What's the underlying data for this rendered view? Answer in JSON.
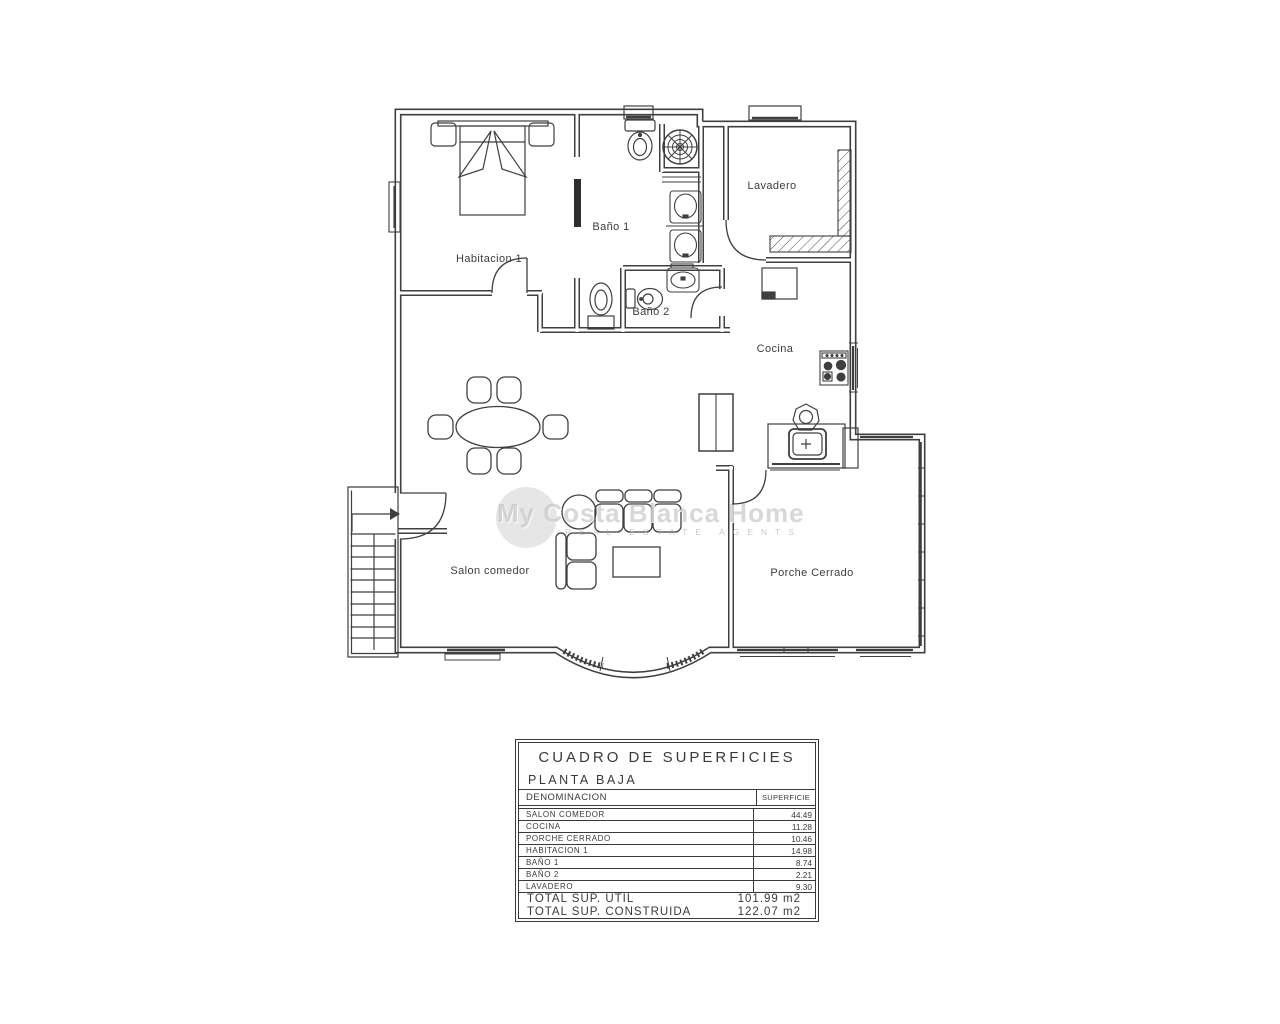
{
  "watermark": {
    "brand": "My Costa Blanca Home",
    "tagline": "REAL ESTATE AGENTS"
  },
  "floorplan": {
    "rooms": [
      {
        "label": "Habitacion 1"
      },
      {
        "label": "Baño 1"
      },
      {
        "label": "Baño 2"
      },
      {
        "label": "Lavadero"
      },
      {
        "label": "Cocina"
      },
      {
        "label": "Salon comedor"
      },
      {
        "label": "Porche Cerrado"
      }
    ]
  },
  "surface_table": {
    "title": "CUADRO DE SUPERFICIES",
    "subtitle": "PLANTA BAJA",
    "columns": {
      "name": "DENOMINACION",
      "area": "SUPERFICIE"
    },
    "rows": [
      {
        "name": "SALON COMEDOR",
        "area": "44.49"
      },
      {
        "name": "COCINA",
        "area": "11.28"
      },
      {
        "name": "PORCHE CERRADO",
        "area": "10.46"
      },
      {
        "name": "HABITACION 1",
        "area": "14.98"
      },
      {
        "name": "BAÑO 1",
        "area": "8.74"
      },
      {
        "name": "BAÑO 2",
        "area": "2.21"
      },
      {
        "name": "LAVADERO",
        "area": "9.30"
      }
    ],
    "totals": [
      {
        "label": "TOTAL SUP. UTIL",
        "value": "101.99 m2"
      },
      {
        "label": "TOTAL SUP. CONSTRUIDA",
        "value": "122.07 m2"
      }
    ]
  },
  "colors": {
    "line": "#3f3f3f",
    "watermark": "#c6c6c6"
  }
}
